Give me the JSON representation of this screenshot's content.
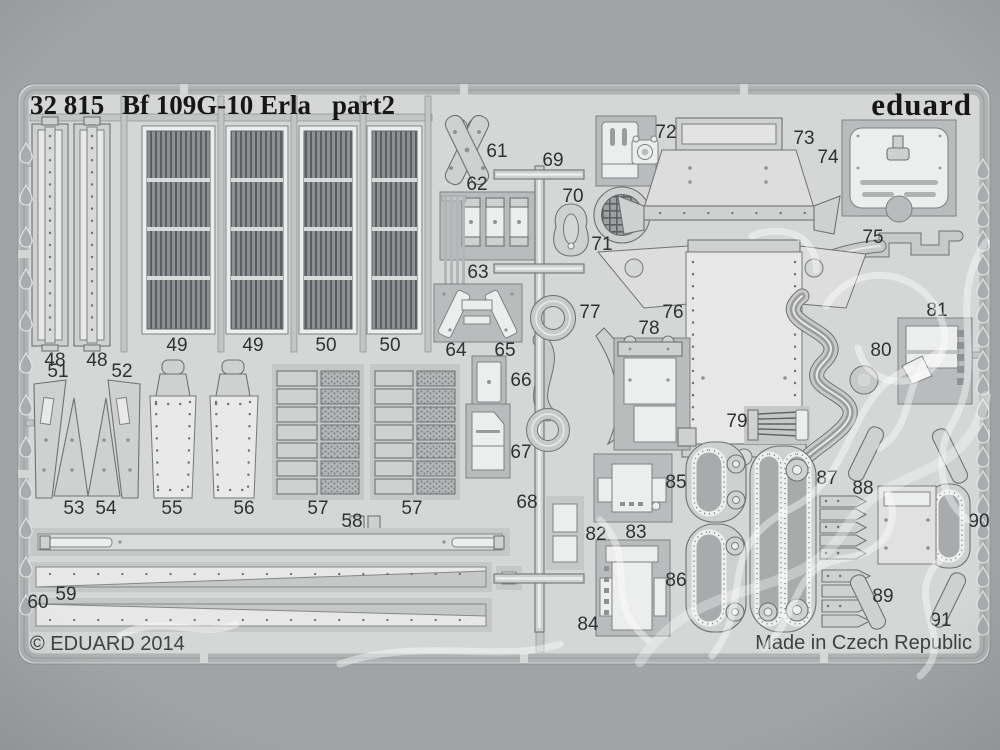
{
  "colors": {
    "background": "#a1a4a6",
    "sheet": "#d5d7d6",
    "part_light": "#eceded",
    "part_mid": "#cfd1d0",
    "ink": "#2f3133",
    "watermark": "#ffffff"
  },
  "header": {
    "catalog_no": "32 815",
    "title": "Bf 109G-10 Erla",
    "part_suffix": "part2",
    "brand": "eduard"
  },
  "footer": {
    "copyright": "© EDUARD 2014",
    "origin": "Made in Czech Republic"
  },
  "part_labels": [
    {
      "num": "48"
    },
    {
      "num": "48"
    },
    {
      "num": "49"
    },
    {
      "num": "49"
    },
    {
      "num": "50"
    },
    {
      "num": "50"
    },
    {
      "num": "51"
    },
    {
      "num": "52"
    },
    {
      "num": "53"
    },
    {
      "num": "54"
    },
    {
      "num": "55"
    },
    {
      "num": "56"
    },
    {
      "num": "57"
    },
    {
      "num": "57"
    },
    {
      "num": "58"
    },
    {
      "num": "59"
    },
    {
      "num": "60"
    },
    {
      "num": "61"
    },
    {
      "num": "62"
    },
    {
      "num": "63"
    },
    {
      "num": "64"
    },
    {
      "num": "65"
    },
    {
      "num": "66"
    },
    {
      "num": "67"
    },
    {
      "num": "68"
    },
    {
      "num": "69"
    },
    {
      "num": "70"
    },
    {
      "num": "71"
    },
    {
      "num": "72"
    },
    {
      "num": "73"
    },
    {
      "num": "74"
    },
    {
      "num": "75"
    },
    {
      "num": "76"
    },
    {
      "num": "77"
    },
    {
      "num": "78"
    },
    {
      "num": "79"
    },
    {
      "num": "80"
    },
    {
      "num": "81"
    },
    {
      "num": "82"
    },
    {
      "num": "83"
    },
    {
      "num": "84"
    },
    {
      "num": "85"
    },
    {
      "num": "86"
    },
    {
      "num": "87"
    },
    {
      "num": "88"
    },
    {
      "num": "89"
    },
    {
      "num": "90"
    },
    {
      "num": "91"
    }
  ]
}
